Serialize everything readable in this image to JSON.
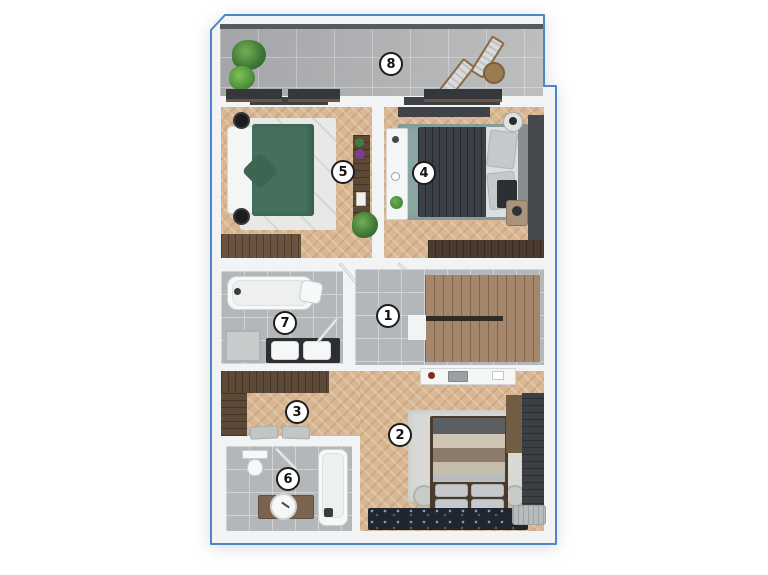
{
  "floorplan": {
    "outline_color": "#4a86c9",
    "rooms": [
      {
        "name": "hallway-stairs",
        "number": "1"
      },
      {
        "name": "bedroom-bottom",
        "number": "2"
      },
      {
        "name": "corridor",
        "number": "3"
      },
      {
        "name": "bedroom-top-right",
        "number": "4"
      },
      {
        "name": "bedroom-top-left",
        "number": "5"
      },
      {
        "name": "bathroom-small",
        "number": "6"
      },
      {
        "name": "bathroom-main",
        "number": "7"
      },
      {
        "name": "terrace",
        "number": "8"
      }
    ],
    "palette": {
      "wood_floor": "#d9b792",
      "tile_floor": "#b4b7ba",
      "wall": "#f1f3f4",
      "green_bed": "#45705c",
      "dark_bed": "#3b4046",
      "teal_rug": "#8ba5a2",
      "navy_carpet": "#1f2531"
    }
  }
}
